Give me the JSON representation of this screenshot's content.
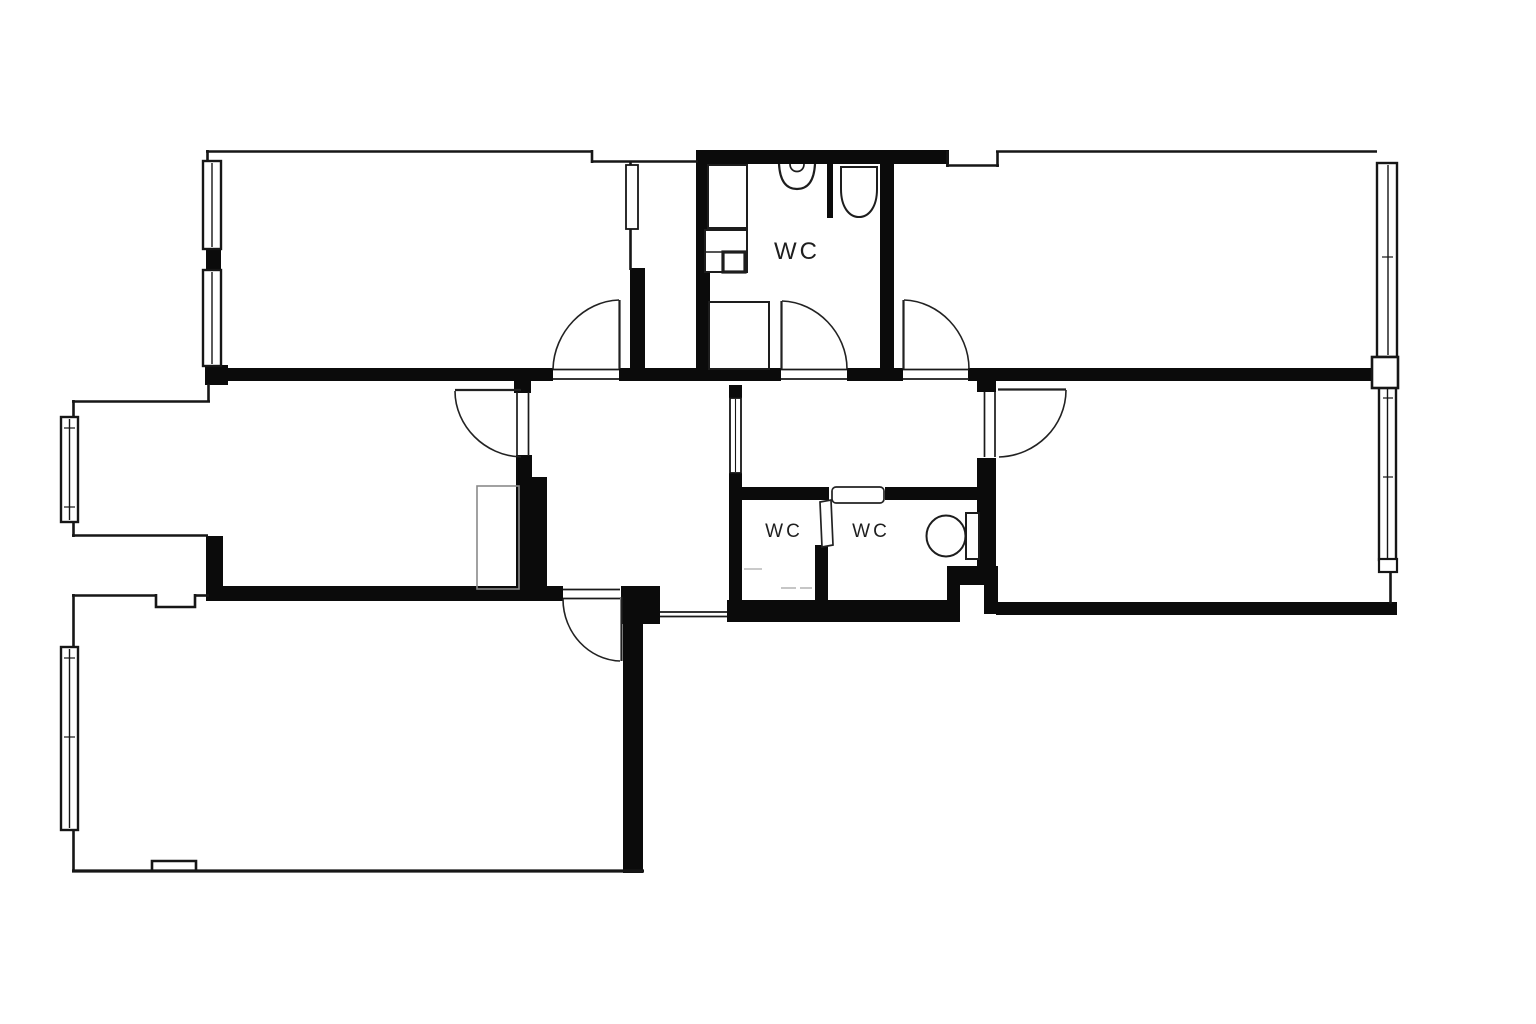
{
  "labels": {
    "bathroom_wc": "WC",
    "wc_small_left": "WC",
    "wc_small_right": "WC"
  },
  "colors": {
    "background": "#ffffff",
    "walls": "#0b0b0b",
    "thin_line": "#161616",
    "faint_line": "#b5b5b5"
  }
}
